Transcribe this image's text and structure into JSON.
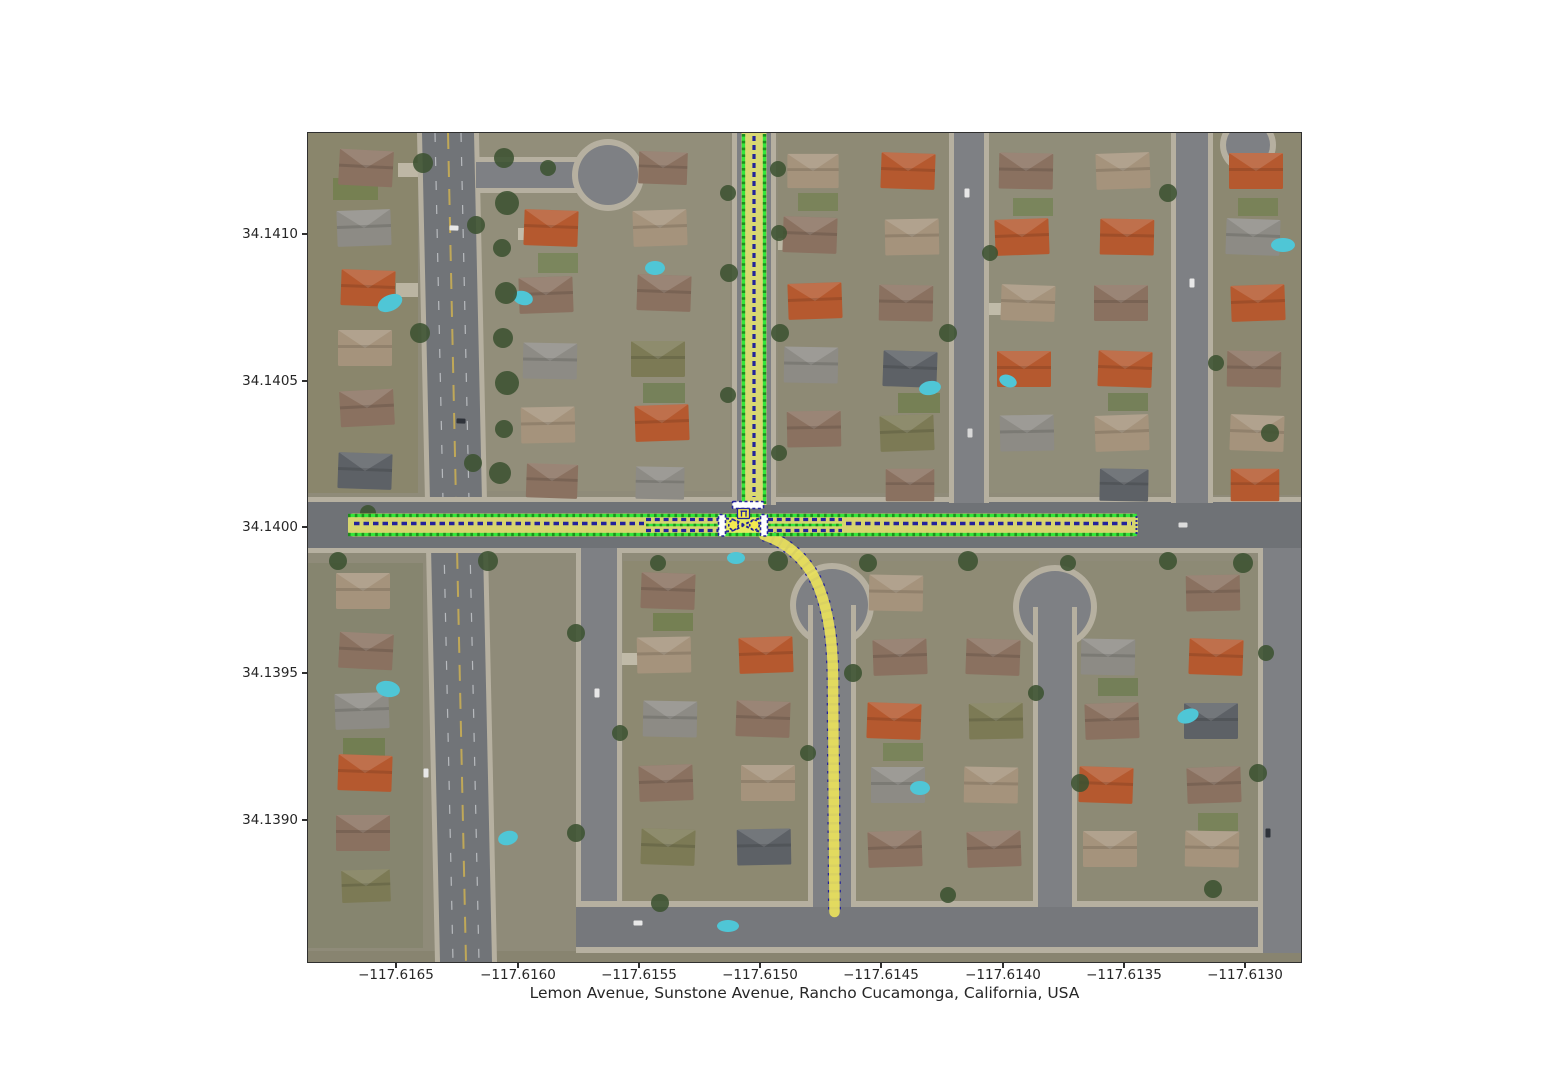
{
  "figure": {
    "xlabel": "Lemon Avenue, Sunstone Avenue, Rancho Cucamonga, California, USA",
    "x_tick_labels": [
      "−117.6165",
      "−117.6160",
      "−117.6155",
      "−117.6150",
      "−117.6145",
      "−117.6140",
      "−117.6135",
      "−117.6130"
    ],
    "y_tick_labels": [
      "34.1410",
      "34.1405",
      "34.1400",
      "34.1395",
      "34.1390"
    ]
  },
  "overlay": {
    "colors": {
      "lane_boundary": "#35e63a",
      "lane_boundary_dark": "#1d8f1d",
      "lane_fill": "#f0ee6e",
      "junction_fill": "#e9ee62",
      "centerline": "#23239b",
      "stop_line_fill": "#ffffff",
      "turn_path_fill": "#eae25c",
      "marker_circle_fill": "#f3e94f"
    }
  },
  "scene": {
    "colors": {
      "houses": [
        "#8a7160",
        "#b5592f",
        "#a5937c",
        "#8d8b85",
        "#5d6166",
        "#7c7a55",
        "#b09a7e"
      ],
      "tree": "#3c5231",
      "pool": "#4fc6d6"
    },
    "patches": [
      [
        0,
        0,
        110,
        360,
        "#85815e",
        0.45
      ],
      [
        0,
        430,
        115,
        385,
        "#7d7f63",
        0.45
      ],
      [
        172,
        0,
        250,
        358,
        "#96917b",
        0.5
      ],
      [
        470,
        0,
        178,
        360,
        "#8f8a70",
        0.45
      ],
      [
        680,
        0,
        188,
        360,
        "#928f79",
        0.5
      ],
      [
        903,
        0,
        90,
        362,
        "#8a8668",
        0.45
      ],
      [
        315,
        428,
        188,
        345,
        "#8b8768",
        0.45
      ],
      [
        543,
        428,
        188,
        345,
        "#908b70",
        0.45
      ],
      [
        768,
        428,
        190,
        345,
        "#8c8970",
        0.45
      ],
      [
        0,
        818,
        993,
        11,
        "#87836f",
        0.9
      ],
      [
        25,
        45,
        45,
        22,
        "#6d7e47",
        0.7
      ],
      [
        230,
        120,
        40,
        20,
        "#6d8049",
        0.6
      ],
      [
        335,
        250,
        42,
        20,
        "#647844",
        0.6
      ],
      [
        490,
        60,
        40,
        18,
        "#6d7e47",
        0.6
      ],
      [
        590,
        260,
        42,
        20,
        "#66793f",
        0.6
      ],
      [
        705,
        65,
        40,
        18,
        "#6d8049",
        0.6
      ],
      [
        800,
        260,
        40,
        18,
        "#647844",
        0.6
      ],
      [
        930,
        65,
        40,
        18,
        "#6d7e47",
        0.6
      ],
      [
        345,
        480,
        40,
        18,
        "#66793f",
        0.6
      ],
      [
        575,
        610,
        40,
        18,
        "#6d8049",
        0.6
      ],
      [
        790,
        545,
        40,
        18,
        "#647844",
        0.6
      ],
      [
        890,
        680,
        40,
        18,
        "#6d7e47",
        0.6
      ],
      [
        35,
        605,
        42,
        20,
        "#66793f",
        0.6
      ],
      [
        90,
        30,
        22,
        14,
        "#c3bdac",
        0.9
      ],
      [
        88,
        150,
        22,
        14,
        "#c3bdac",
        0.85
      ],
      [
        210,
        95,
        25,
        12,
        "#c9c3b2",
        0.85
      ],
      [
        470,
        105,
        28,
        12,
        "#c3bdac",
        0.85
      ],
      [
        675,
        170,
        26,
        12,
        "#c9c3b2",
        0.85
      ],
      [
        868,
        105,
        28,
        12,
        "#c3bdac",
        0.85
      ],
      [
        310,
        520,
        26,
        12,
        "#c9c3b2",
        0.85
      ],
      [
        730,
        590,
        26,
        12,
        "#c3bdac",
        0.85
      ],
      [
        955,
        590,
        30,
        12,
        "#c9c3b2",
        0.85
      ]
    ],
    "houses": [
      [
        58,
        35,
        3,
        1,
        0
      ],
      [
        56,
        95,
        -2,
        1,
        3
      ],
      [
        60,
        155,
        2,
        1,
        1
      ],
      [
        57,
        215,
        0,
        1,
        2
      ],
      [
        59,
        275,
        -3,
        1,
        0
      ],
      [
        57,
        338,
        2,
        1,
        4
      ],
      [
        55,
        458,
        0,
        1,
        2
      ],
      [
        58,
        518,
        3,
        1,
        0
      ],
      [
        54,
        578,
        -2,
        1,
        3
      ],
      [
        57,
        640,
        2,
        1,
        1
      ],
      [
        55,
        700,
        0,
        1,
        0
      ],
      [
        58,
        753,
        -2,
        0.9,
        5
      ],
      [
        243,
        95,
        2,
        1,
        1
      ],
      [
        238,
        162,
        -2,
        1,
        0
      ],
      [
        242,
        228,
        1,
        1,
        3
      ],
      [
        240,
        292,
        -1,
        1,
        2
      ],
      [
        244,
        348,
        2,
        0.95,
        0
      ],
      [
        352,
        95,
        -2,
        1,
        2
      ],
      [
        356,
        160,
        2,
        1,
        0
      ],
      [
        350,
        226,
        0,
        1,
        5
      ],
      [
        354,
        290,
        -2,
        1,
        1
      ],
      [
        352,
        350,
        1,
        0.9,
        3
      ],
      [
        355,
        35,
        2,
        0.9,
        0
      ],
      [
        505,
        38,
        0,
        0.95,
        2
      ],
      [
        502,
        102,
        2,
        1,
        0
      ],
      [
        507,
        168,
        -2,
        1,
        1
      ],
      [
        503,
        232,
        1,
        1,
        3
      ],
      [
        506,
        296,
        -1,
        1,
        0
      ],
      [
        600,
        38,
        2,
        1,
        1
      ],
      [
        604,
        104,
        -1,
        1,
        2
      ],
      [
        598,
        170,
        1,
        1,
        0
      ],
      [
        602,
        236,
        2,
        1,
        4
      ],
      [
        599,
        300,
        -2,
        1,
        5
      ],
      [
        602,
        352,
        0,
        0.9,
        0
      ],
      [
        718,
        38,
        1,
        1,
        0
      ],
      [
        714,
        104,
        -2,
        1,
        1
      ],
      [
        720,
        170,
        2,
        1,
        2
      ],
      [
        716,
        236,
        0,
        1,
        1
      ],
      [
        719,
        300,
        -1,
        1,
        3
      ],
      [
        815,
        38,
        -2,
        1,
        2
      ],
      [
        819,
        104,
        1,
        1,
        1
      ],
      [
        813,
        170,
        0,
        1,
        0
      ],
      [
        817,
        236,
        2,
        1,
        1
      ],
      [
        814,
        300,
        -2,
        1,
        2
      ],
      [
        816,
        352,
        1,
        0.9,
        4
      ],
      [
        948,
        38,
        0,
        1,
        1
      ],
      [
        945,
        104,
        2,
        1,
        3
      ],
      [
        950,
        170,
        -2,
        1,
        1
      ],
      [
        946,
        236,
        1,
        1,
        0
      ],
      [
        949,
        300,
        2,
        1,
        2
      ],
      [
        947,
        352,
        0,
        0.9,
        1
      ],
      [
        360,
        458,
        2,
        1,
        0
      ],
      [
        356,
        522,
        -1,
        1,
        2
      ],
      [
        362,
        586,
        1,
        1,
        3
      ],
      [
        358,
        650,
        -2,
        1,
        0
      ],
      [
        360,
        714,
        2,
        1,
        5
      ],
      [
        458,
        522,
        -2,
        1,
        1
      ],
      [
        455,
        586,
        2,
        1,
        0
      ],
      [
        460,
        650,
        0,
        1,
        2
      ],
      [
        456,
        714,
        -1,
        1,
        4
      ],
      [
        588,
        460,
        1,
        1,
        2
      ],
      [
        592,
        524,
        -2,
        1,
        0
      ],
      [
        586,
        588,
        2,
        1,
        1
      ],
      [
        590,
        652,
        0,
        1,
        3
      ],
      [
        587,
        716,
        -2,
        1,
        0
      ],
      [
        685,
        524,
        2,
        1,
        0
      ],
      [
        688,
        588,
        -1,
        1,
        5
      ],
      [
        683,
        652,
        1,
        1,
        2
      ],
      [
        686,
        716,
        -2,
        1,
        0
      ],
      [
        800,
        524,
        1,
        1,
        3
      ],
      [
        804,
        588,
        -2,
        1,
        0
      ],
      [
        798,
        652,
        2,
        1,
        1
      ],
      [
        802,
        716,
        0,
        1,
        2
      ],
      [
        905,
        460,
        -1,
        1,
        0
      ],
      [
        908,
        524,
        2,
        1,
        1
      ],
      [
        903,
        588,
        0,
        1,
        4
      ],
      [
        906,
        652,
        -2,
        1,
        0
      ],
      [
        904,
        716,
        1,
        1,
        2
      ]
    ],
    "trees": [
      [
        196,
        25,
        10
      ],
      [
        199,
        70,
        12
      ],
      [
        194,
        115,
        9
      ],
      [
        198,
        160,
        11
      ],
      [
        195,
        205,
        10
      ],
      [
        199,
        250,
        12
      ],
      [
        196,
        296,
        9
      ],
      [
        192,
        340,
        11
      ],
      [
        30,
        428,
        9
      ],
      [
        180,
        428,
        10
      ],
      [
        350,
        430,
        8
      ],
      [
        470,
        428,
        10
      ],
      [
        560,
        430,
        9
      ],
      [
        660,
        428,
        10
      ],
      [
        760,
        430,
        8
      ],
      [
        860,
        428,
        9
      ],
      [
        935,
        430,
        10
      ],
      [
        420,
        60,
        8
      ],
      [
        421,
        140,
        9
      ],
      [
        471,
        100,
        8
      ],
      [
        472,
        200,
        9
      ],
      [
        420,
        262,
        8
      ],
      [
        471,
        320,
        8
      ],
      [
        640,
        200,
        9
      ],
      [
        682,
        120,
        8
      ],
      [
        860,
        60,
        9
      ],
      [
        908,
        230,
        8
      ],
      [
        962,
        300,
        9
      ],
      [
        268,
        500,
        9
      ],
      [
        312,
        600,
        8
      ],
      [
        268,
        700,
        9
      ],
      [
        500,
        620,
        8
      ],
      [
        545,
        540,
        9
      ],
      [
        728,
        560,
        8
      ],
      [
        772,
        650,
        9
      ],
      [
        958,
        520,
        8
      ],
      [
        950,
        640,
        9
      ],
      [
        352,
        770,
        9
      ],
      [
        640,
        762,
        8
      ],
      [
        905,
        756,
        9
      ],
      [
        115,
        30,
        10
      ],
      [
        168,
        92,
        9
      ],
      [
        112,
        200,
        10
      ],
      [
        165,
        330,
        9
      ],
      [
        60,
        380,
        8
      ],
      [
        240,
        35,
        8
      ],
      [
        470,
        36,
        8
      ]
    ],
    "pools": [
      [
        82,
        170,
        13,
        8,
        -25
      ],
      [
        215,
        165,
        10,
        7,
        15
      ],
      [
        347,
        135,
        10,
        7,
        0
      ],
      [
        622,
        255,
        11,
        7,
        -10
      ],
      [
        700,
        248,
        9,
        6,
        20
      ],
      [
        975,
        112,
        12,
        7,
        0
      ],
      [
        80,
        556,
        12,
        8,
        10
      ],
      [
        200,
        705,
        10,
        7,
        -15
      ],
      [
        420,
        793,
        11,
        6,
        0
      ],
      [
        612,
        655,
        10,
        7,
        0
      ],
      [
        880,
        583,
        11,
        7,
        -20
      ],
      [
        428,
        425,
        9,
        6,
        0
      ]
    ],
    "cars": [
      [
        146,
        95,
        2,
        "#e8e8e8"
      ],
      [
        153,
        288,
        2,
        "#2f333a"
      ],
      [
        659,
        60,
        90,
        "#e8e8e8"
      ],
      [
        662,
        300,
        90,
        "#d8d8d8"
      ],
      [
        884,
        150,
        90,
        "#e8e8e8"
      ],
      [
        289,
        560,
        90,
        "#e8e8e8"
      ],
      [
        330,
        790,
        0,
        "#e8e8e8"
      ],
      [
        960,
        700,
        90,
        "#2f333a"
      ],
      [
        118,
        640,
        90,
        "#e8e8e8"
      ],
      [
        875,
        392,
        0,
        "#dcdcdc"
      ]
    ]
  }
}
